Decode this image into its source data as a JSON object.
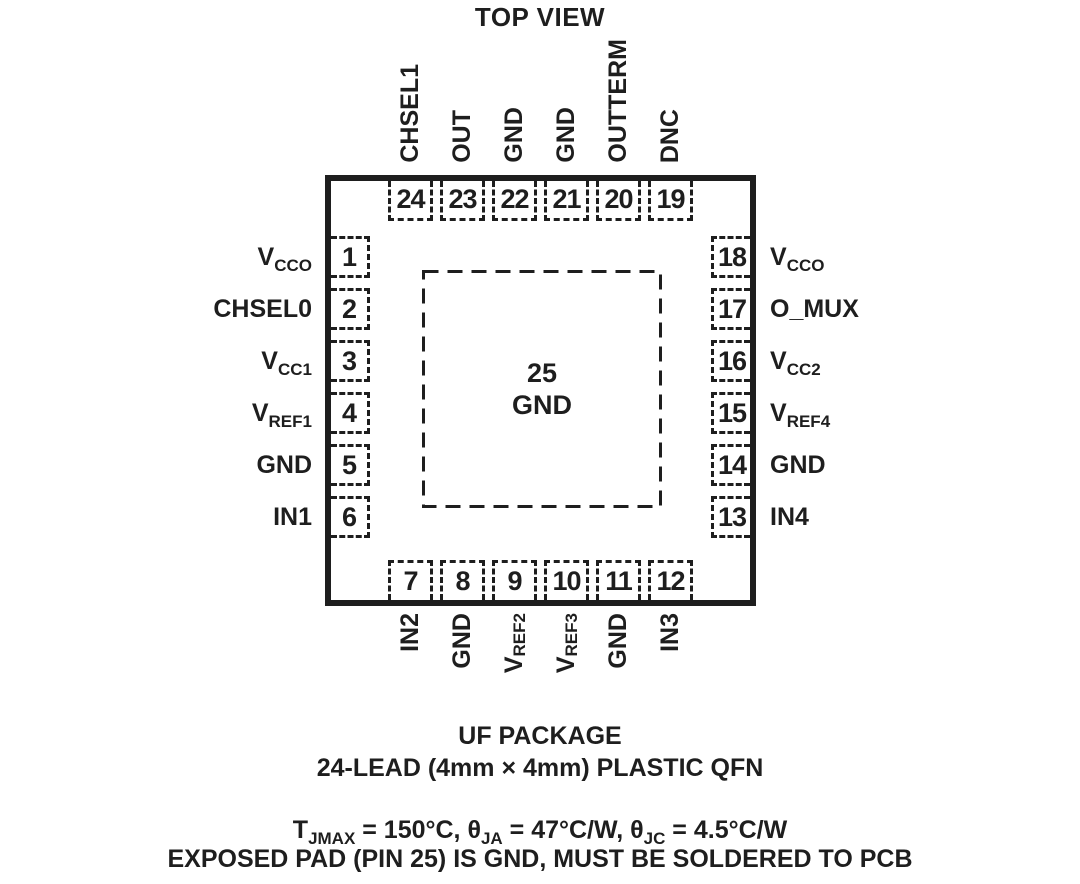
{
  "colors": {
    "ink": "#1e1e1e",
    "bg": "#ffffff"
  },
  "title": "TOP VIEW",
  "chip": {
    "pad": {
      "number": "25",
      "label": "GND"
    },
    "pins": {
      "top": [
        {
          "number": "24",
          "label": "CHSEL1"
        },
        {
          "number": "23",
          "label": "OUT"
        },
        {
          "number": "22",
          "label": "GND"
        },
        {
          "number": "21",
          "label": "GND"
        },
        {
          "number": "20",
          "label": "OUTTERM"
        },
        {
          "number": "19",
          "label": "DNC"
        }
      ],
      "bottom": [
        {
          "number": "7",
          "label": "IN2"
        },
        {
          "number": "8",
          "label": "GND"
        },
        {
          "number": "9",
          "label": "V_{REF2}"
        },
        {
          "number": "10",
          "label": "V_{REF3}"
        },
        {
          "number": "11",
          "label": "GND"
        },
        {
          "number": "12",
          "label": "IN3"
        }
      ],
      "left": [
        {
          "number": "1",
          "label": "V_{CCO}"
        },
        {
          "number": "2",
          "label": "CHSEL0"
        },
        {
          "number": "3",
          "label": "V_{CC1}"
        },
        {
          "number": "4",
          "label": "V_{REF1}"
        },
        {
          "number": "5",
          "label": "GND"
        },
        {
          "number": "6",
          "label": "IN1"
        }
      ],
      "right": [
        {
          "number": "18",
          "label": "V_{CCO}"
        },
        {
          "number": "17",
          "label": "O_MUX"
        },
        {
          "number": "16",
          "label": "V_{CC2}"
        },
        {
          "number": "15",
          "label": "V_{REF4}"
        },
        {
          "number": "14",
          "label": "GND"
        },
        {
          "number": "13",
          "label": "IN4"
        }
      ]
    }
  },
  "footer": {
    "package_name": "UF PACKAGE",
    "package_desc": "24-LEAD (4mm × 4mm) PLASTIC QFN",
    "thermal": "T_{JMAX} = 150°C, θ_{JA} = 47°C/W, θ_{JC} = 4.5°C/W",
    "note": "EXPOSED PAD (PIN 25) IS GND, MUST BE SOLDERED TO PCB"
  }
}
